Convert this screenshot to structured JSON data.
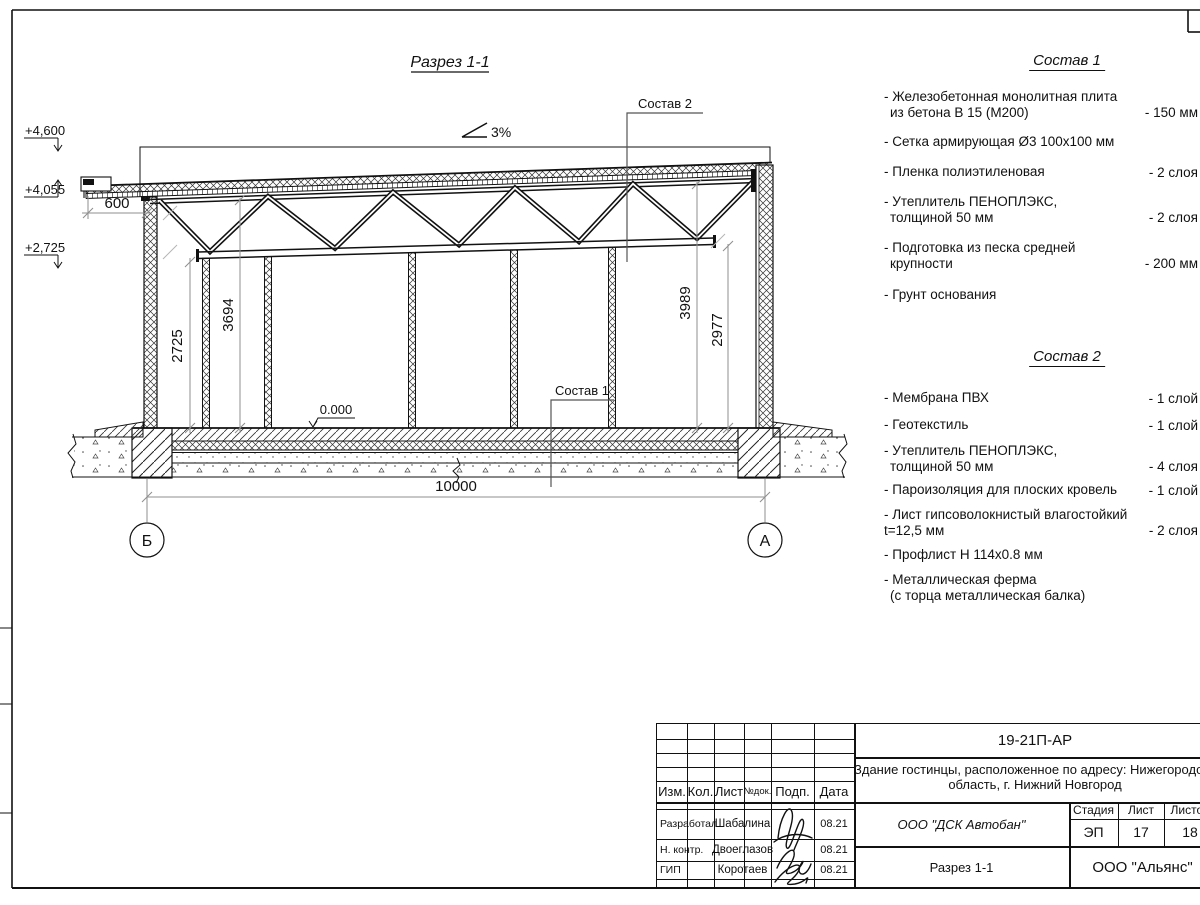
{
  "drawing": {
    "title": "Разрез 1-1",
    "slope_label": "3%",
    "elev_top": "+4,600",
    "elev_roof_edge": "+4,055",
    "elev_truss": "+2,725",
    "elev_floor": "0.000",
    "dim_overhang": "600",
    "dim_height_left_wall": "2725",
    "dim_height_left": "3694",
    "dim_height_right": "3989",
    "dim_height_right_wall": "2977",
    "dim_span": "10000",
    "axis_left": "Б",
    "axis_right": "А",
    "callout_1": "Состав 1",
    "callout_2": "Состав 2"
  },
  "composition1": {
    "title": "Состав 1",
    "items": [
      {
        "l1": "- Железобетонная  монолитная плита",
        "l2": "из бетона В 15 (М200)",
        "value": "- 150 мм"
      },
      {
        "l1": "- Сетка армирующая Ø3 100х100 мм",
        "l2": "",
        "value": ""
      },
      {
        "l1": "- Пленка полиэтиленовая",
        "l2": "",
        "value": "-  2 слоя"
      },
      {
        "l1": "- Утеплитель ПЕНОПЛЭКС,",
        "l2": "толщиной 50 мм",
        "value": "- 2 слоя"
      },
      {
        "l1": "- Подготовка из песка средней",
        "l2": "крупности",
        "value": "- 200 мм"
      },
      {
        "l1": "- Грунт основания",
        "l2": "",
        "value": ""
      }
    ]
  },
  "composition2": {
    "title": "Состав 2",
    "items": [
      {
        "l1": "- Мембрана ПВХ",
        "l2": "",
        "value": "- 1 слой"
      },
      {
        "l1": "- Геотекстиль",
        "l2": "",
        "value": "- 1 слой"
      },
      {
        "l1": "- Утеплитель ПЕНОПЛЭКС,",
        "l2": "толщиной 50 мм",
        "value": "- 4 слоя"
      },
      {
        "l1": "- Пароизоляция для плоских кровель",
        "l2": "",
        "value": "- 1 слой"
      },
      {
        "l1": "- Лист гипсоволокнистый влагостойкий",
        "l2": "t=12,5 мм",
        "value": "- 2 слоя"
      },
      {
        "l1": "- Профлист Н 114х0.8 мм",
        "l2": "",
        "value": ""
      },
      {
        "l1": "- Металлическая ферма",
        "l2": "(с торца металлическая балка)",
        "value": ""
      }
    ]
  },
  "titleblock": {
    "doc_number": "19-21П-АР",
    "project_line1": "Здание гостинцы, расположенное по адресу: Нижегородская",
    "project_line2": "область, г. Нижний Новгород",
    "col_izm": "Изм.",
    "col_kol": "Кол.",
    "col_list": "Лист",
    "col_ndok": "№док.",
    "col_podp": "Подп.",
    "col_data": "Дата",
    "row1_role": "Разработал",
    "row1_name": "Шабалина",
    "row1_date": "08.21",
    "row2_role": "Н. контр.",
    "row2_name": "Двоеглазов",
    "row2_date": "08.21",
    "row3_role": "ГИП",
    "row3_name": "Коротаев",
    "row3_date": "08.21",
    "org": "ООО \"ДСК Автобан\"",
    "sheet_title": "Разрез 1-1",
    "stage_label": "Стадия",
    "sheet_label": "Лист",
    "sheets_label": "Листов",
    "stage_value": "ЭП",
    "sheet_value": "17",
    "sheets_value": "18",
    "company": "ООО \"Альянс\""
  }
}
